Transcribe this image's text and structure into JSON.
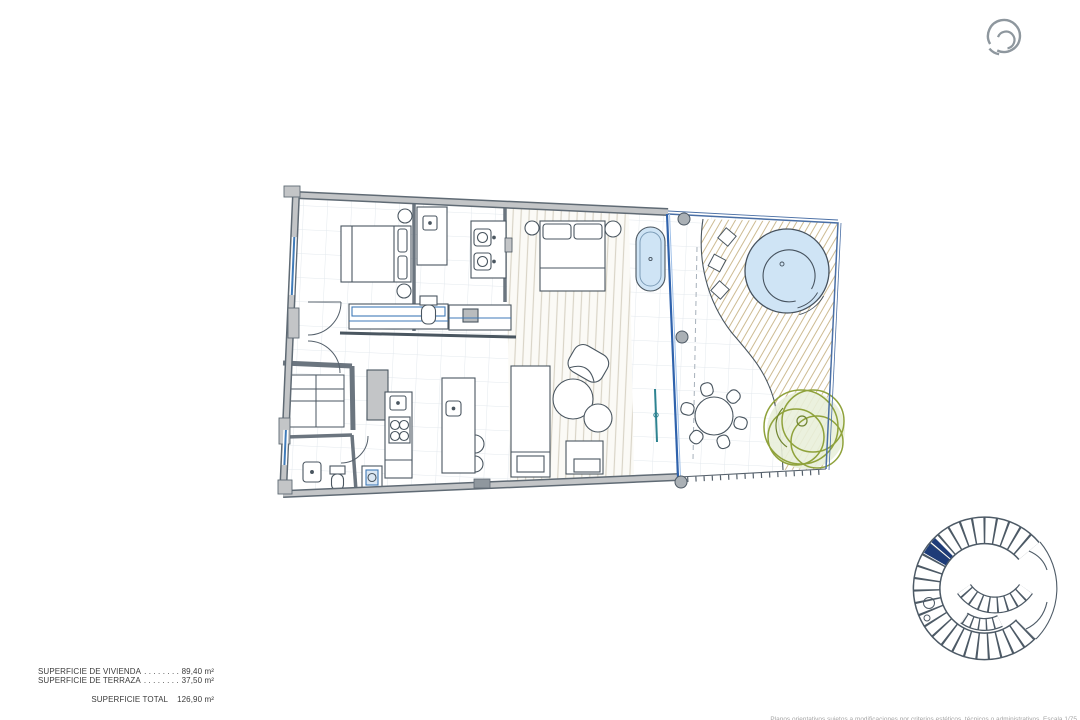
{
  "summary": {
    "rows": [
      {
        "label": "SUPERFICIE DE VIVIENDA",
        "dots": ". . . . . . . . . .",
        "value": "89,40 m²"
      },
      {
        "label": "SUPERFICIE DE TERRAZA",
        "dots": ". . . . . . . . . .",
        "value": "37,50 m²"
      }
    ],
    "total": {
      "label": "SUPERFICIE TOTAL",
      "value": "126,90 m²"
    }
  },
  "footnote": "Planos orientativos sujetos a modificaciones por criterios estéticos, técnicos o administrativos. Escala 1/75",
  "floorplan": {
    "elements": [
      "bedroom-bed",
      "wardrobe",
      "bathroom-shower",
      "bathroom-vanity",
      "toilet",
      "master-bed",
      "bathtub",
      "kitchen-cooktop",
      "kitchen-island",
      "sofa",
      "armchair",
      "coffee-tables",
      "glass-facade",
      "columns",
      "terrace-plunge-pool",
      "terrace-deck",
      "outdoor-dining-set",
      "tree"
    ],
    "colors": {
      "wall_fill": "#c3c5c7",
      "wall_edge": "#5f6a74",
      "line": "#4a5660",
      "tile_grid": "#e3e8ed",
      "glass_blue": "#2f62ac",
      "water_blue": "#cfe4f5",
      "deck_hatch": "#cdbb92",
      "tree_green": "#8fa23b",
      "keyplan_highlight": "#1e3c78",
      "logo_gray": "#8e979e"
    }
  }
}
